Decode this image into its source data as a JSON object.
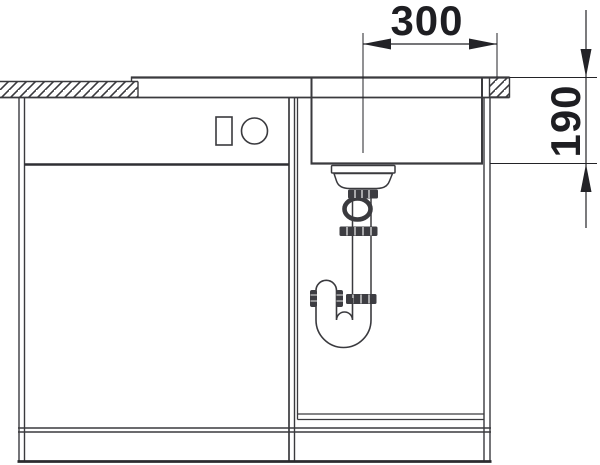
{
  "drawing": {
    "dimensions": {
      "top_width": "300",
      "right_depth": "190"
    },
    "colors": {
      "line": "#3a3a3e",
      "dim_line": "#232327",
      "text": "#1e1e22",
      "background": "#ffffff",
      "nut_fill": "#3d3d42"
    },
    "icons": {
      "front_panel_rectangle": "rectangle-outline",
      "front_panel_circle": "circle-outline"
    }
  }
}
